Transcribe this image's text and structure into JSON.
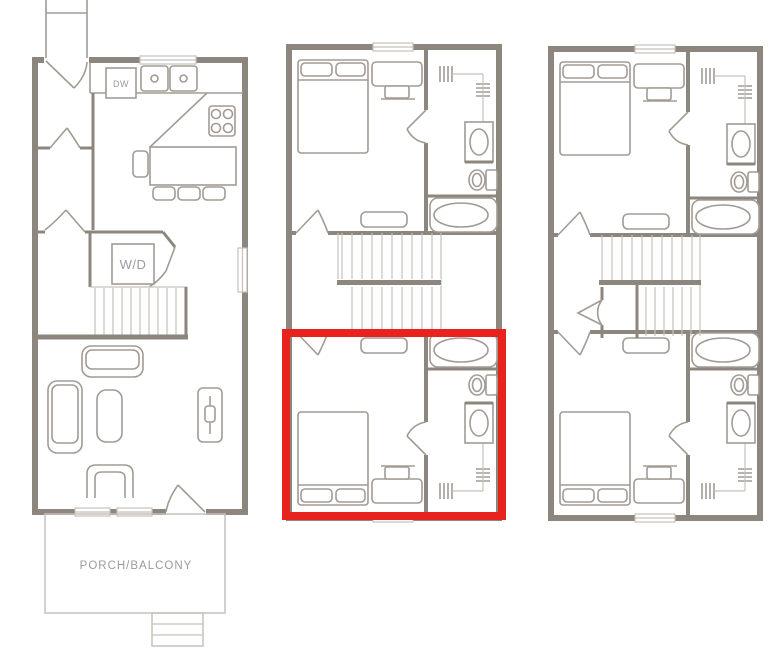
{
  "colors": {
    "background": "#ffffff",
    "wall": "#8d867e",
    "line": "#a29b94",
    "light": "#c6c1bb",
    "text": "#9b9b9b",
    "highlight": "#e8221c"
  },
  "labels": {
    "dishwasher": "DW",
    "washer_dryer": "W/D",
    "porch": "PORCH/BALCONY"
  },
  "panels": [
    {
      "id": "first-floor",
      "position": "left",
      "fixtures": [
        "entry-door",
        "kitchen-counter",
        "dishwasher",
        "double-sink",
        "cooktop",
        "kitchen-island",
        "bar-stools",
        "dining-chair",
        "hall-closet-doors",
        "washer-dryer-closet",
        "staircase",
        "loveseat",
        "sectional-sofa",
        "ottoman",
        "accent-chair",
        "media-console",
        "porch-door",
        "porch-balcony",
        "porch-steps",
        "windows"
      ]
    },
    {
      "id": "second-floor",
      "position": "center",
      "fixtures": [
        "bed",
        "pillows",
        "dresser-with-tv",
        "bench",
        "closet-rods",
        "vanity-sink",
        "toilet",
        "bathtub",
        "staircase",
        "doors",
        "windows"
      ],
      "highlight": {
        "present": true,
        "color": "#e8221c",
        "area": "lower-bedroom-suite"
      }
    },
    {
      "id": "third-floor",
      "position": "right",
      "fixtures": [
        "bed",
        "pillows",
        "dresser-with-tv",
        "bench",
        "closet-rods",
        "vanity-sink",
        "toilet",
        "bathtub",
        "staircase",
        "double-swing-door",
        "doors",
        "windows"
      ],
      "highlight": {
        "present": false
      }
    }
  ]
}
